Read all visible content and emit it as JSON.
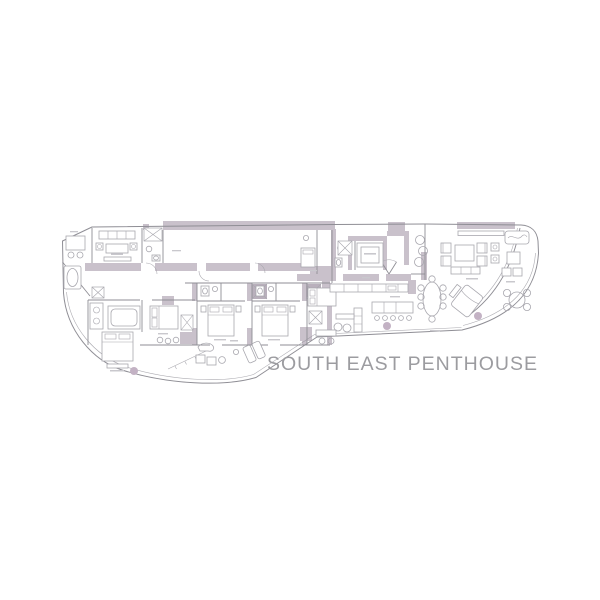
{
  "title": {
    "text": "SOUTH EAST PENTHOUSE"
  },
  "colors": {
    "background": "#ffffff",
    "wall_fill": "#c9c1cb",
    "wall_fill_dark": "#b9b0bc",
    "outline_line": "#8f8e95",
    "furniture_line": "#a8a7ae",
    "label_mark": "#c9c8cd",
    "accent_dot": "#c3b2c4",
    "title_text": "#9c9ca0"
  },
  "icons": {
    "closet_x_icon": "crossed-box",
    "elevator_icon": "crossed-box",
    "shower_icon": "crossed-box"
  }
}
